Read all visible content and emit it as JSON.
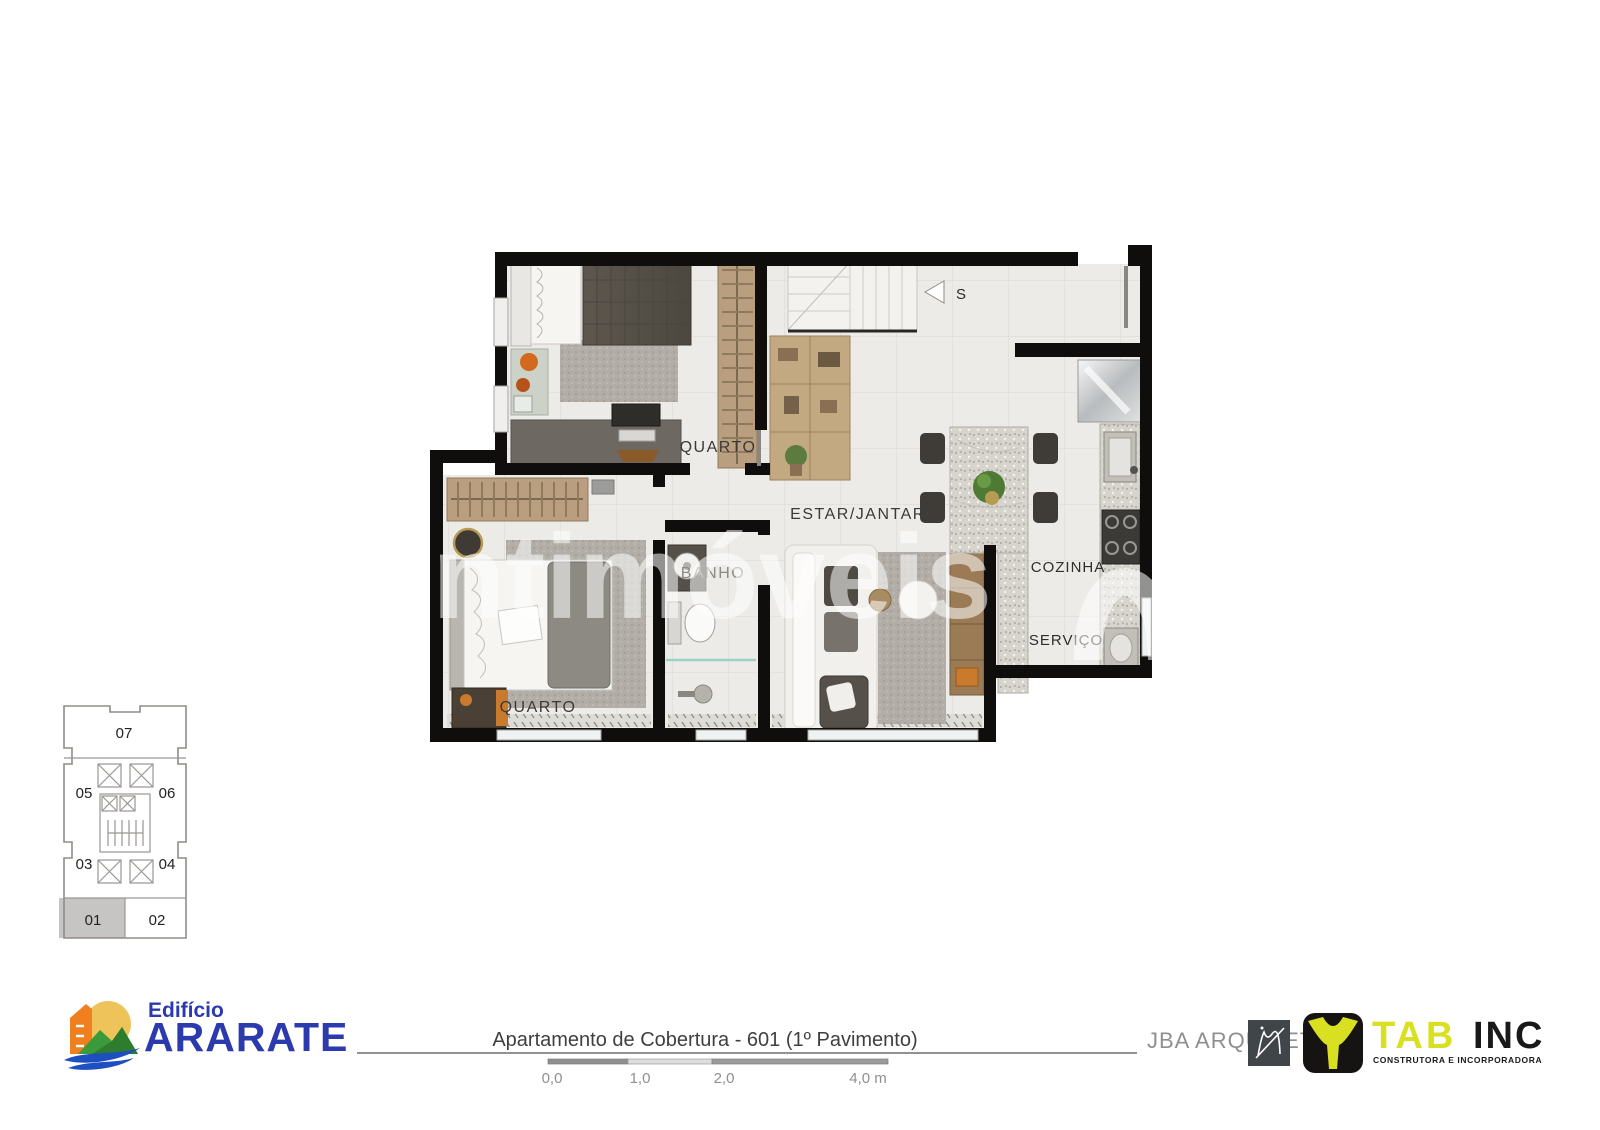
{
  "watermark": {
    "text": "ntimóveis"
  },
  "plan": {
    "rooms": [
      {
        "id": "quarto-top",
        "label": "QUARTO"
      },
      {
        "id": "quarto-bottom",
        "label": "QUARTO"
      },
      {
        "id": "banho",
        "label": "BANHO"
      },
      {
        "id": "estar-jantar",
        "label": "ESTAR/JANTAR"
      },
      {
        "id": "cozinha",
        "label": "COZINHA"
      },
      {
        "id": "servico",
        "label": "SERVIÇO"
      }
    ],
    "stair_label": "S"
  },
  "key_plan": {
    "units": [
      "07",
      "05",
      "06",
      "03",
      "04",
      "01",
      "02"
    ],
    "highlighted_unit": "01"
  },
  "footer": {
    "building_name_small": "Edifício",
    "building_name": "ARARATE",
    "title": "Apartamento de Cobertura - 601 (1º Pavimento)",
    "scale_labels": [
      "0,0",
      "1,0",
      "2,0",
      "4,0 m"
    ],
    "architect": "JBA ARQUITETURA",
    "builder_name": "TAB",
    "builder_suffix": "INC",
    "builder_subtitle": "CONSTRUTORA E INCORPORADORA"
  },
  "colors": {
    "brand_blue": "#2b3aad",
    "tab_yellow": "#d9e021",
    "logo_orange": "#f07f1f",
    "logo_green": "#3b9a3a",
    "logo_wave_blue": "#1d4fc0",
    "wall_black": "#0f0e0c",
    "floor": "#edebe8",
    "highlight_gray": "#c6c5c3"
  }
}
